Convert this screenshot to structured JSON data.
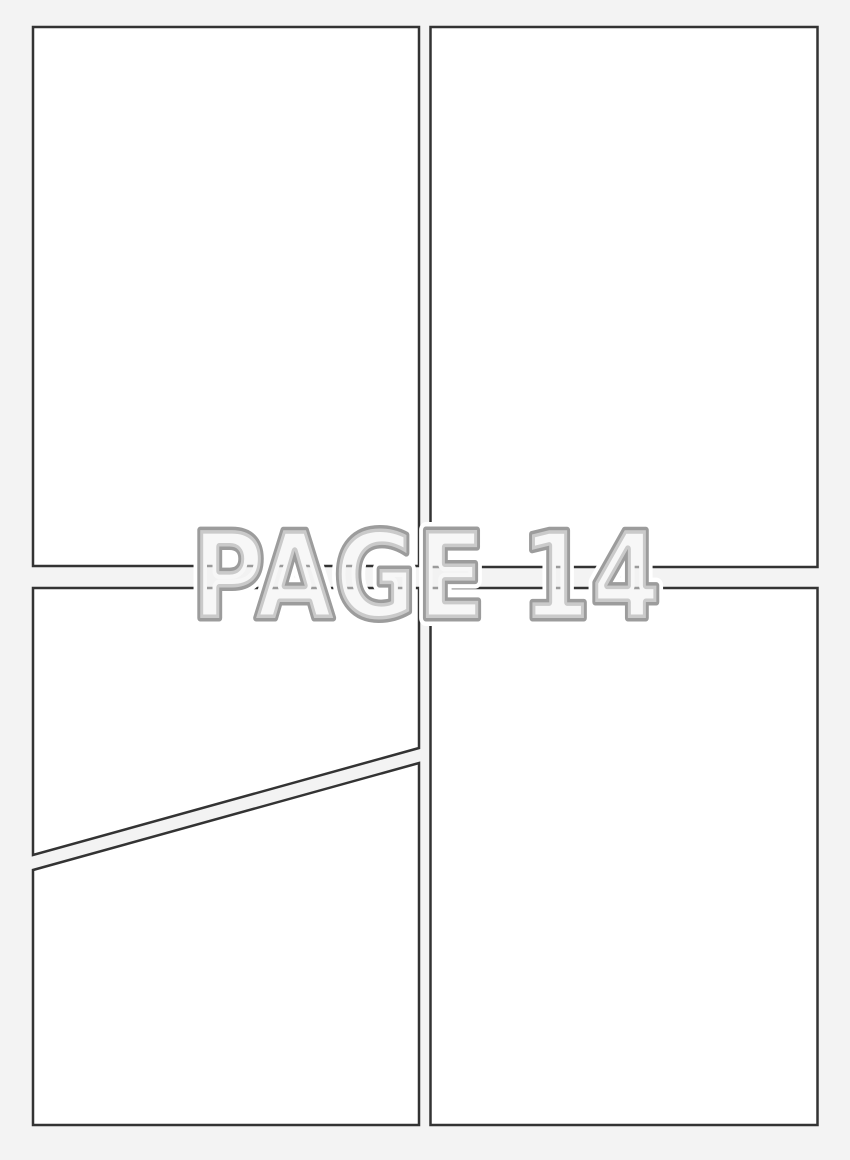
{
  "watermark": {
    "text": "PAGE 14"
  },
  "colors": {
    "background": "#f3f3f3",
    "panel_fill": "#ffffff",
    "panel_border": "#333333",
    "watermark_fill": "#f0f0f0",
    "watermark_outline": "#9c9c9c",
    "watermark_halo": "#ffffff"
  }
}
